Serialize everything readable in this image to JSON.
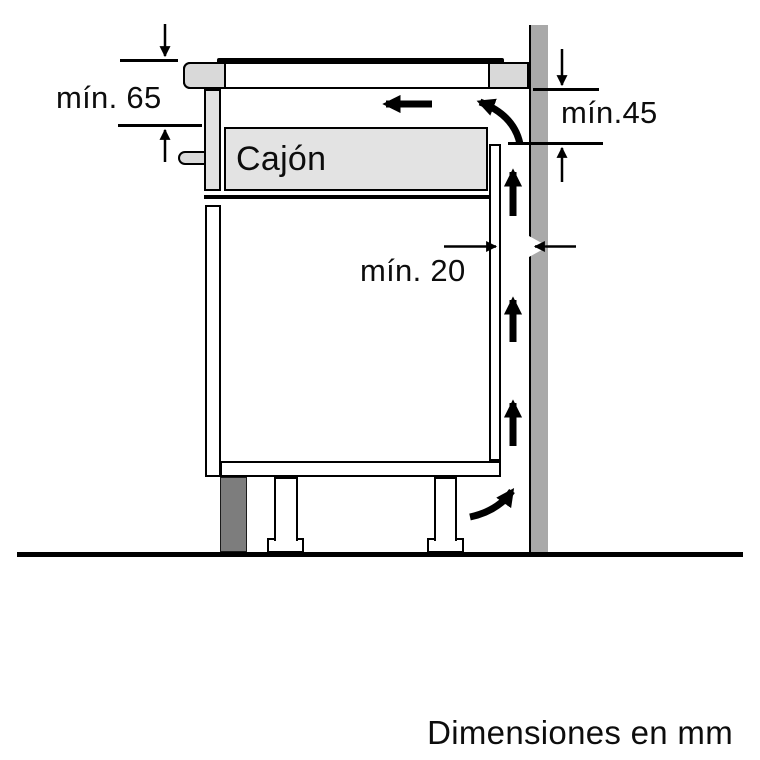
{
  "labels": {
    "drawer": "Cajón",
    "dim_top_left": "mín. 65",
    "dim_right": "mín.45",
    "dim_gap": "mín. 20",
    "note": "Dimensiones en mm"
  },
  "colors": {
    "wall": "#a9a9a9",
    "plinth": "#7d7d7d",
    "counter": "#d9d9d9",
    "panel": "#e3e3e3",
    "line": "#000000",
    "bg": "#ffffff"
  }
}
